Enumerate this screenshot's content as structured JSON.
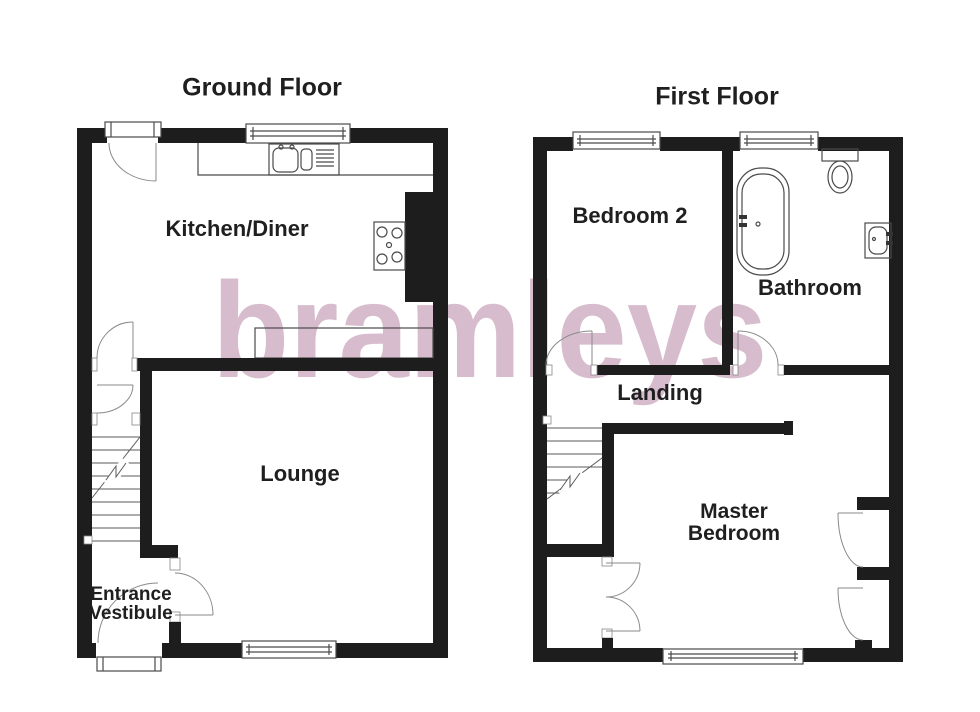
{
  "watermark": {
    "text": "bramleys",
    "color": "#d7bccd"
  },
  "ground_floor": {
    "title": "Ground Floor",
    "rooms": {
      "kitchen_diner": "Kitchen/Diner",
      "lounge": "Lounge",
      "entrance_vestibule_line1": "Entrance",
      "entrance_vestibule_line2": "Vestibule"
    }
  },
  "first_floor": {
    "title": "First Floor",
    "rooms": {
      "bedroom2": "Bedroom 2",
      "bathroom": "Bathroom",
      "landing": "Landing",
      "master_line1": "Master",
      "master_line2": "Bedroom"
    }
  },
  "colors": {
    "wall": "#1d1d1d",
    "thin_line": "#4a4a4a",
    "door_arc": "#8a8a8a",
    "watermark": "#d7bccd",
    "label_text": "#1f1f1f"
  }
}
